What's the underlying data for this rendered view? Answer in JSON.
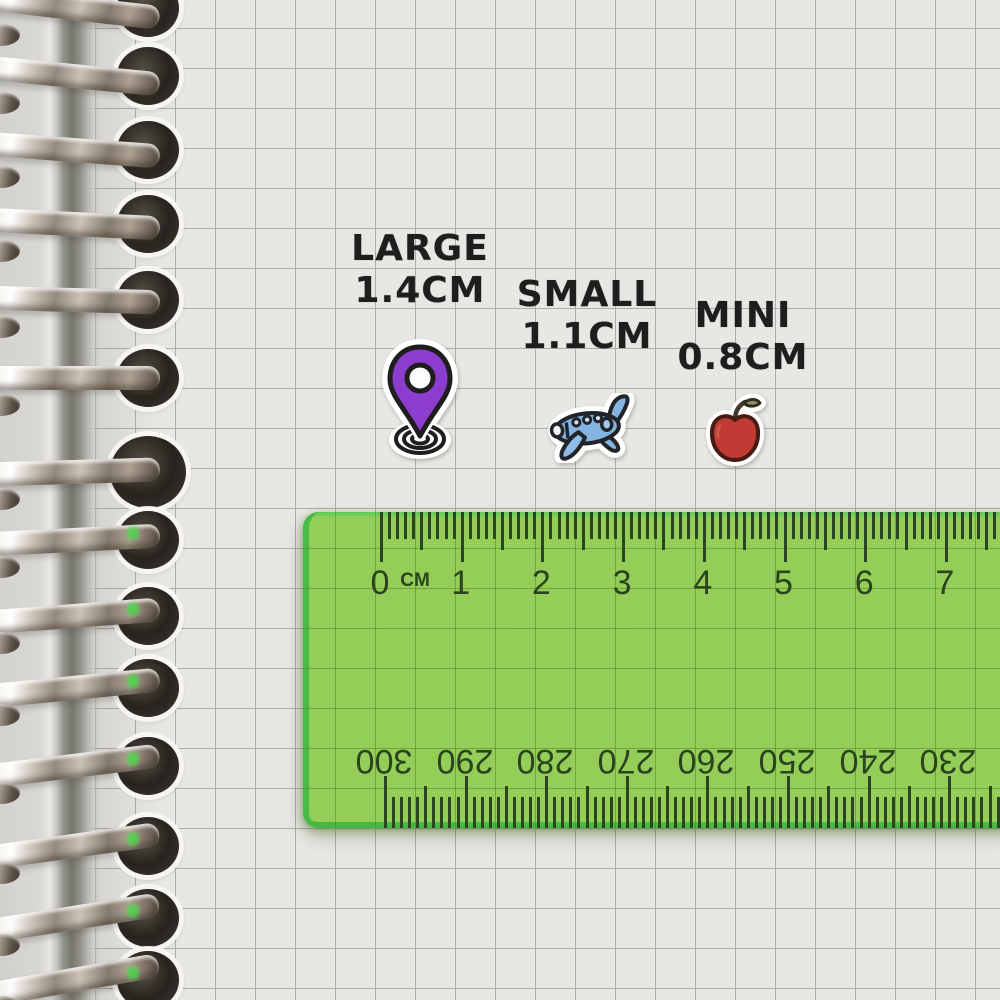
{
  "labels": {
    "large": {
      "name": "LARGE",
      "size": "1.4CM"
    },
    "small": {
      "name": "SMALL",
      "size": "1.1CM"
    },
    "mini": {
      "name": "MINI",
      "size": "0.8CM"
    }
  },
  "stickers": {
    "pin": {
      "icon": "location-pin-icon",
      "color": "#8531ca"
    },
    "plane": {
      "icon": "airplane-icon",
      "color": "#7cb0e0"
    },
    "apple": {
      "icon": "apple-icon",
      "color": "#bb2f26",
      "leaf_color": "#8b8b60"
    }
  },
  "ruler": {
    "unit_label": "CM",
    "top_numbers": [
      "0",
      "1",
      "2",
      "3",
      "4",
      "5",
      "6",
      "7"
    ],
    "bottom_numbers": [
      "300",
      "290",
      "280",
      "270",
      "260",
      "250",
      "240",
      "230"
    ],
    "colors": {
      "body": "#8cc84a",
      "edge": "#3cb33e",
      "marks": "#1d3a12"
    }
  }
}
